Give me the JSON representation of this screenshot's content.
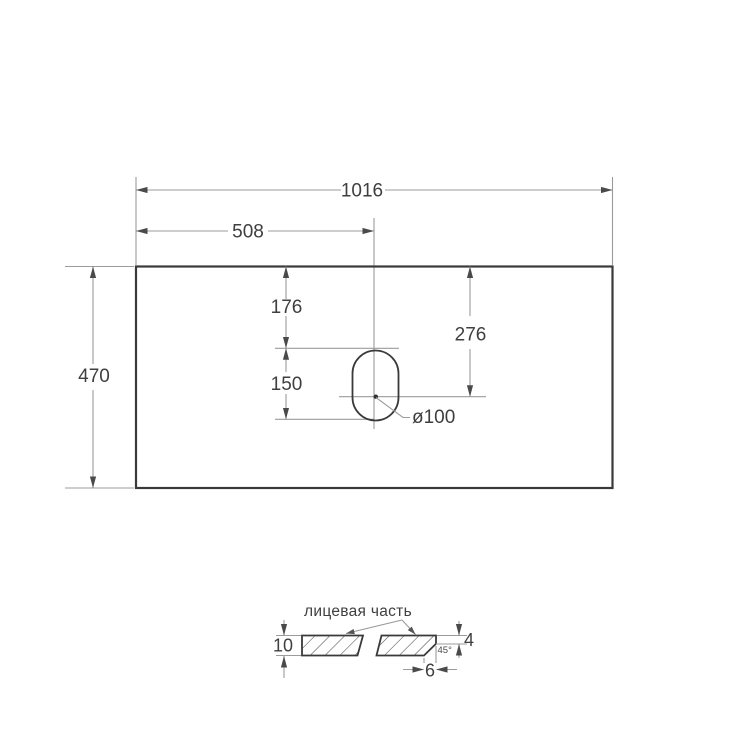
{
  "drawing": {
    "description": "Dimensional technical drawing of a countertop slab with oval faucet hole and edge section detail",
    "labels": {
      "width": "1016",
      "half_width": "508",
      "depth": "470",
      "hole_offset_top": "176",
      "hole_span": "150",
      "hole_center_from_top": "276",
      "hole_diameter": "ø100",
      "face_side": "лицевая часть",
      "thickness": "10",
      "front_edge_height": "4",
      "chamfer_angle": "45°",
      "chamfer_depth": "6"
    },
    "colors": {
      "outline": "#3a3a3a",
      "dimension_line": "#9b9b9b",
      "text": "#3f3f3f",
      "background": "#ffffff"
    }
  }
}
